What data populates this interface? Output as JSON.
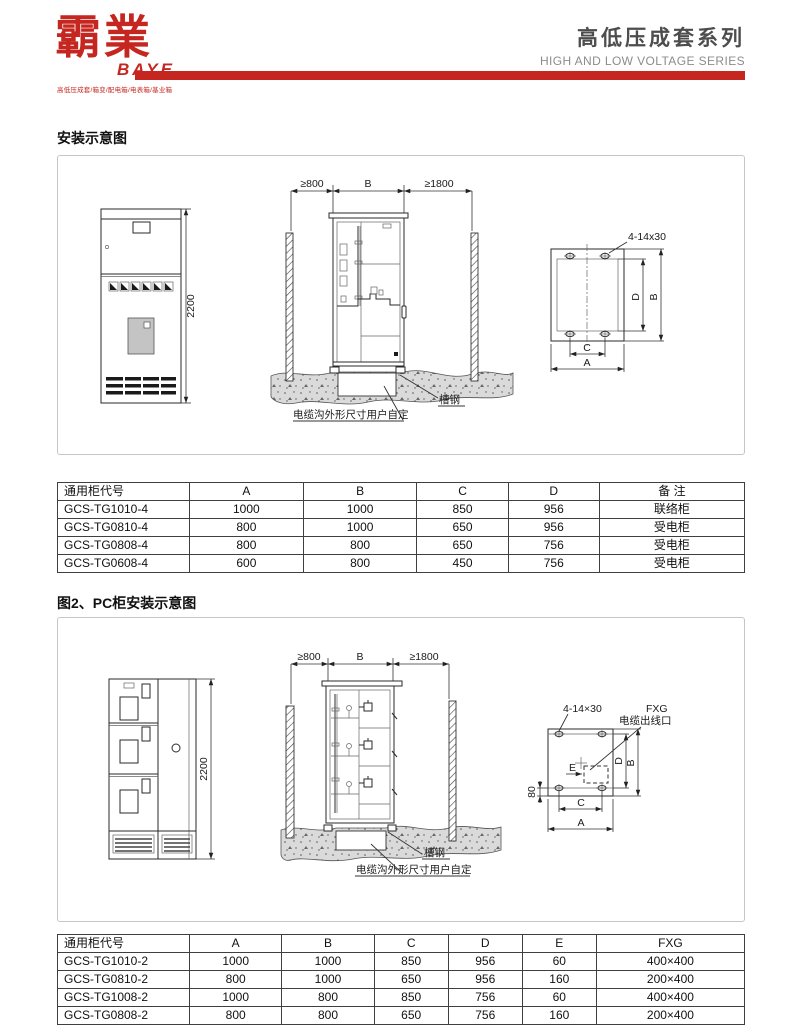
{
  "header": {
    "logo": {
      "cn": "霸業",
      "en": "BAYE",
      "tagline": "高低压成套/箱变/配电箱/电表箱/基业箱"
    },
    "title_cn": "高低压成套系列",
    "title_en": "HIGH AND LOW VOLTAGE SERIES",
    "accent_color": "#c5261f"
  },
  "section1": {
    "title": "安装示意图",
    "diagram": {
      "dim_height": "2200",
      "dim_left": "≥800",
      "dim_width": "B",
      "dim_right": "≥1800",
      "label_channel_steel": "槽钢",
      "label_cable_trench": "电缆沟外形尺寸用户自定",
      "label_bolt": "4-14x30",
      "dim_a": "A",
      "dim_b": "B",
      "dim_c": "C",
      "dim_d": "D"
    },
    "table": {
      "headers": [
        "通用柜代号",
        "A",
        "B",
        "C",
        "D",
        "备 注"
      ],
      "rows": [
        [
          "GCS-TG1010-4",
          "1000",
          "1000",
          "850",
          "956",
          "联络柜"
        ],
        [
          "GCS-TG0810-4",
          "800",
          "1000",
          "650",
          "956",
          "受电柜"
        ],
        [
          "GCS-TG0808-4",
          "800",
          "800",
          "650",
          "756",
          "受电柜"
        ],
        [
          "GCS-TG0608-4",
          "600",
          "800",
          "450",
          "756",
          "受电柜"
        ]
      ]
    }
  },
  "section2": {
    "title": "图2、PC柜安装示意图",
    "diagram": {
      "dim_height": "2200",
      "dim_left": "≥800",
      "dim_width": "B",
      "dim_right": "≥1800",
      "label_channel_steel": "槽钢",
      "label_cable_trench": "电缆沟外形尺寸用户自定",
      "label_bolt": "4-14×30",
      "label_fxg": "FXG",
      "label_cable_outlet": "电缆出线口",
      "dim_a": "A",
      "dim_b": "B",
      "dim_c": "C",
      "dim_d": "D",
      "dim_e": "E",
      "dim_80": "80"
    },
    "table": {
      "headers": [
        "通用柜代号",
        "A",
        "B",
        "C",
        "D",
        "E",
        "FXG"
      ],
      "rows": [
        [
          "GCS-TG1010-2",
          "1000",
          "1000",
          "850",
          "956",
          "60",
          "400×400"
        ],
        [
          "GCS-TG0810-2",
          "800",
          "1000",
          "650",
          "956",
          "160",
          "200×400"
        ],
        [
          "GCS-TG1008-2",
          "1000",
          "800",
          "850",
          "756",
          "60",
          "400×400"
        ],
        [
          "GCS-TG0808-2",
          "800",
          "800",
          "650",
          "756",
          "160",
          "200×400"
        ]
      ]
    }
  }
}
